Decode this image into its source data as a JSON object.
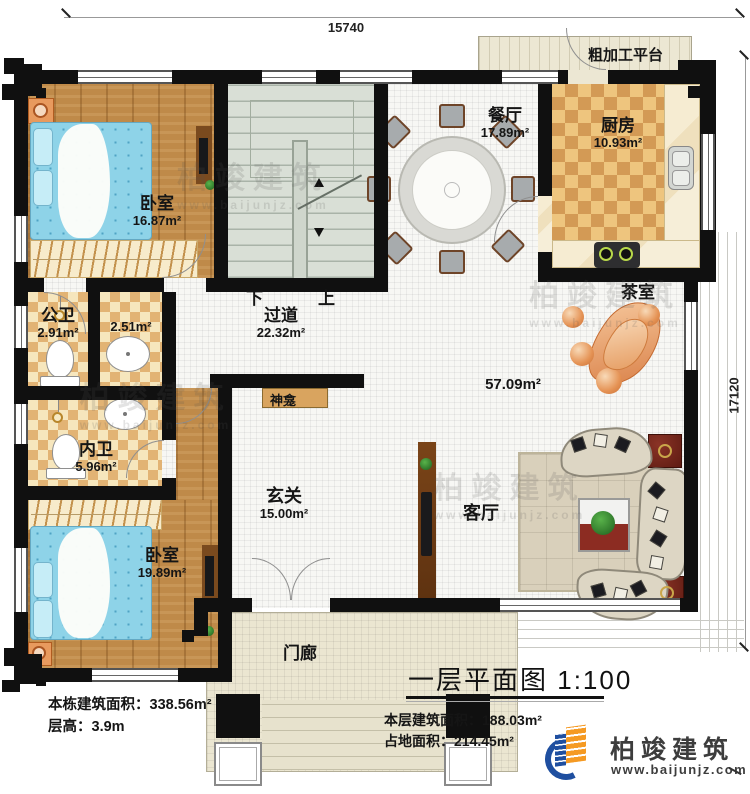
{
  "dimensions": {
    "top_width": "15740",
    "right_height": "17120"
  },
  "outdoor": {
    "platform": "粗加工平台",
    "porch": "门廊"
  },
  "rooms": {
    "bedroom1": {
      "name": "卧室",
      "area": "16.87m²"
    },
    "dining": {
      "name": "餐厅",
      "area": "17.89m²"
    },
    "kitchen": {
      "name": "厨房",
      "area": "10.93m²"
    },
    "public_bath": {
      "name": "公卫",
      "area": "2.91m²"
    },
    "washroom": {
      "name": "",
      "area": "2.51m²"
    },
    "hallway": {
      "name": "过道",
      "area": "22.32m²"
    },
    "tea_room": {
      "name": "茶室",
      "area": ""
    },
    "great_room": {
      "name": "",
      "area": "57.09m²"
    },
    "inner_bath": {
      "name": "内卫",
      "area": "5.96m²"
    },
    "shrine": {
      "name": "神龛"
    },
    "entry": {
      "name": "玄关",
      "area": "15.00m²"
    },
    "living": {
      "name": "客厅",
      "area": ""
    },
    "bedroom2": {
      "name": "卧室",
      "area": "19.89m²"
    }
  },
  "stairs": {
    "down": "下",
    "up": "上"
  },
  "title": {
    "text": "一层平面图",
    "scale": "1:100"
  },
  "notes": {
    "building_total_label": "本栋建筑面积：",
    "building_total_value": "338.56m²",
    "floor_height_label": "层高：",
    "floor_height_value": "3.9m",
    "floor_area_label": "本层建筑面积：",
    "floor_area_value": "188.03m²",
    "footprint_label": "占地面积：",
    "footprint_value": "214.45m²"
  },
  "brand": {
    "name": "柏竣建筑",
    "website": "www.baijunjz.com"
  },
  "watermark": {
    "name": "柏竣建筑",
    "website": "www.baijunjz.com"
  },
  "colors": {
    "wall": "#101010",
    "wood_floor": "#bf8a49",
    "kitchen_tile": "#eec57e",
    "stair": "#d9dfd6",
    "bed": "#8ed3e8",
    "shrine_cabinet": "#d9a45f",
    "logo_blue": "#1f4fa0",
    "logo_orange": "#f59a23"
  }
}
